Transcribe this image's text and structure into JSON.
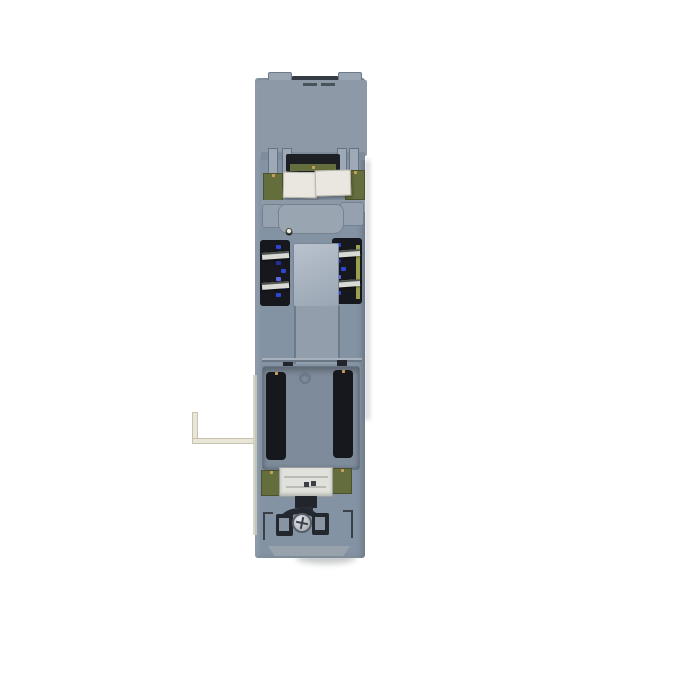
{
  "scene": {
    "subject": "industrial-plc-module-rear-view"
  },
  "colors": {
    "background": "#ffffff",
    "body": "#8493a4",
    "body_light": "#9aa5b2",
    "frame": "#8d99a7",
    "frame_light": "#a3aeba",
    "slat": "#4d5560",
    "recess_dark": "#16181d",
    "pcb_green": "#646e3c",
    "gold": "#c8a05c",
    "gold_dark": "#8a6135",
    "plate_white": "#e9e7e0",
    "plate_white2": "#e0e1db",
    "metal": "#d9dad5",
    "blue_component": "#3145d5",
    "blue_component_light": "#5a68e8",
    "blue_component_dark": "#23309c",
    "center_block": "#aebac6",
    "panel_recess": "#7e8b9a",
    "screw_silver": "#c9cdd2",
    "yellow_strip": "#9ba24d",
    "foot": "#98a2ad",
    "wire": "#e9e6d8",
    "edge_strip": "#ccd0bd",
    "contact_dot": "#f2f0e6",
    "side_shadow": "rgba(90,100,112,0.25)"
  },
  "grille": {
    "bands": 2,
    "columns": 4,
    "slats_per_cell": 5
  },
  "contact_dots": {
    "count": 6
  },
  "pcb_edge_dots": {
    "count": 6
  },
  "pin_headers": {
    "rows": 13,
    "columns": 2
  },
  "pads": {
    "columns": 2,
    "top_rows": 5,
    "bottom_rows": 4
  },
  "speckles": {
    "per_channel": 7
  }
}
